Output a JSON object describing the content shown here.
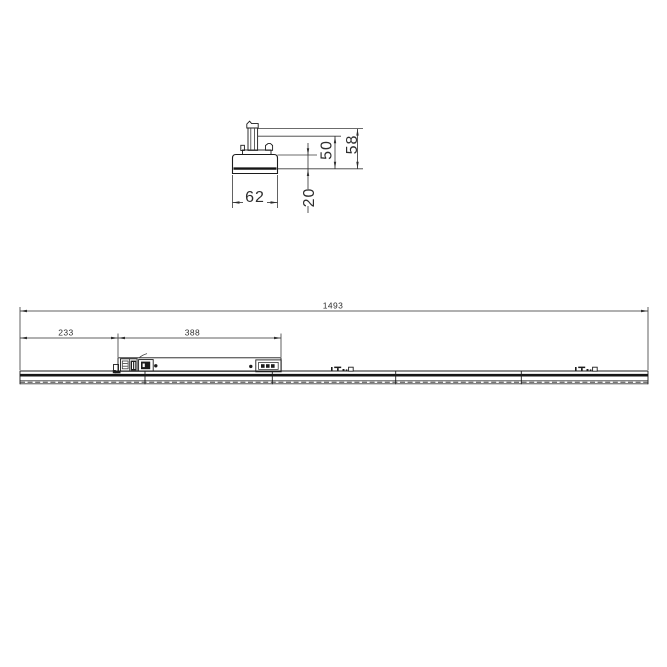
{
  "colors": {
    "background": "#ffffff",
    "line": "#1c1c1c",
    "dim_text": "#2e2e2e"
  },
  "section_view": {
    "label": "cross-section of track luminaire with adapter",
    "dim_width": "62",
    "dim_height_body": "20",
    "dim_height_to_adapter": "50",
    "dim_height_total": "58"
  },
  "side_view": {
    "label": "side elevation of linear track luminaire",
    "dim_overall_length": "1493",
    "dim_left_offset": "233",
    "dim_gear_tray_length": "388"
  }
}
